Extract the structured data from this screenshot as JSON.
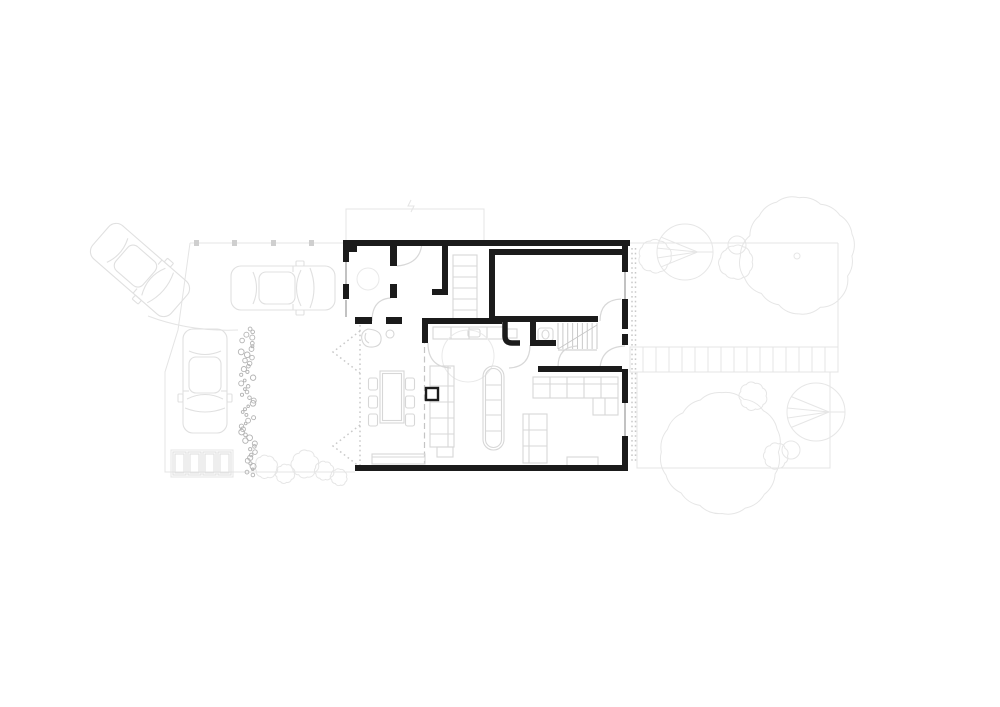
{
  "drawing": {
    "kind": "residential-site-and-ground-floor-plan",
    "canvas": {
      "width": 1000,
      "height": 707
    }
  },
  "palette": {
    "background": "#ffffff",
    "wall": "#1b1b1b",
    "site_line": "#e4e4e4",
    "fence_post": "#cfcfcf",
    "vehicle_line": "#e0e0e0",
    "furniture_line": "#d7d7d7",
    "tree_line": "#e6e6e6",
    "door_arc": "#d8d8d8",
    "stair_line": "#c9c9c9",
    "glazing": "#c2c2c2",
    "dashed_line": "#c4c4c4",
    "dotted_line": "#c9c9c9",
    "hedge_line": "#b3b3b3",
    "faint_line": "#e9e9e9"
  },
  "vehicles": [
    {
      "name": "car-turning",
      "x": 140,
      "y": 270,
      "rotation": 131
    },
    {
      "name": "car-driveway",
      "x": 283,
      "y": 288,
      "rotation": 90
    },
    {
      "name": "car-parked",
      "x": 205,
      "y": 381,
      "rotation": 180
    }
  ],
  "trees": [
    {
      "type": "scallop",
      "x": 655,
      "y": 256,
      "r": 16,
      "n": 10
    },
    {
      "type": "radial",
      "x": 685,
      "y": 252,
      "r": 28
    },
    {
      "type": "scallop",
      "x": 736,
      "y": 262,
      "r": 17,
      "n": 11
    },
    {
      "type": "circle",
      "x": 737,
      "y": 245,
      "r": 9
    },
    {
      "type": "scallop",
      "x": 799,
      "y": 256,
      "r": 57,
      "n": 16
    },
    {
      "type": "circle",
      "x": 797,
      "y": 256,
      "r": 3
    },
    {
      "type": "scallop",
      "x": 722,
      "y": 452,
      "r": 60,
      "n": 16
    },
    {
      "type": "scallop",
      "x": 753,
      "y": 396,
      "r": 13,
      "n": 9
    },
    {
      "type": "radial",
      "x": 816,
      "y": 412,
      "r": 29
    },
    {
      "type": "scallop",
      "x": 776,
      "y": 456,
      "r": 12,
      "n": 9
    },
    {
      "type": "circle",
      "x": 791,
      "y": 450,
      "r": 9
    }
  ],
  "shrubs": [
    {
      "x": 266,
      "y": 467,
      "r": 11
    },
    {
      "x": 285,
      "y": 474,
      "r": 9
    },
    {
      "x": 305,
      "y": 464,
      "r": 13
    },
    {
      "x": 324,
      "y": 471,
      "r": 9
    },
    {
      "x": 339,
      "y": 477,
      "r": 8
    }
  ],
  "hedge": {
    "x": 241,
    "width": 14,
    "y1": 329,
    "y2": 475,
    "count": 52,
    "seed": 11
  },
  "bins": {
    "count": 4,
    "x": 173,
    "y": 452,
    "bin_width": 13,
    "bin_height": 23,
    "gap": 2
  },
  "fence_posts_x": [
    194,
    232,
    271,
    309
  ],
  "terrace_path": {
    "x": 630,
    "y": 347,
    "width": 208,
    "height": 25,
    "divisions": 15
  },
  "gravel_strip": {
    "x1": 632,
    "x2": 635.5,
    "y1": 248,
    "y2": 463
  },
  "stairs": {
    "x": 558,
    "y": 323,
    "width": 39,
    "height": 26,
    "treads": 9
  },
  "patio": {
    "track_line": {
      "x": 360,
      "y1": 325,
      "y2": 465
    },
    "overhang_line": {
      "x": 424.5,
      "y1": 328,
      "y2": 464
    },
    "bifold_chevrons": [
      [
        [
          360,
          331
        ],
        [
          333,
          352
        ],
        [
          360,
          373
        ]
      ],
      [
        [
          360,
          425
        ],
        [
          333,
          446
        ],
        [
          360,
          467
        ]
      ]
    ]
  }
}
